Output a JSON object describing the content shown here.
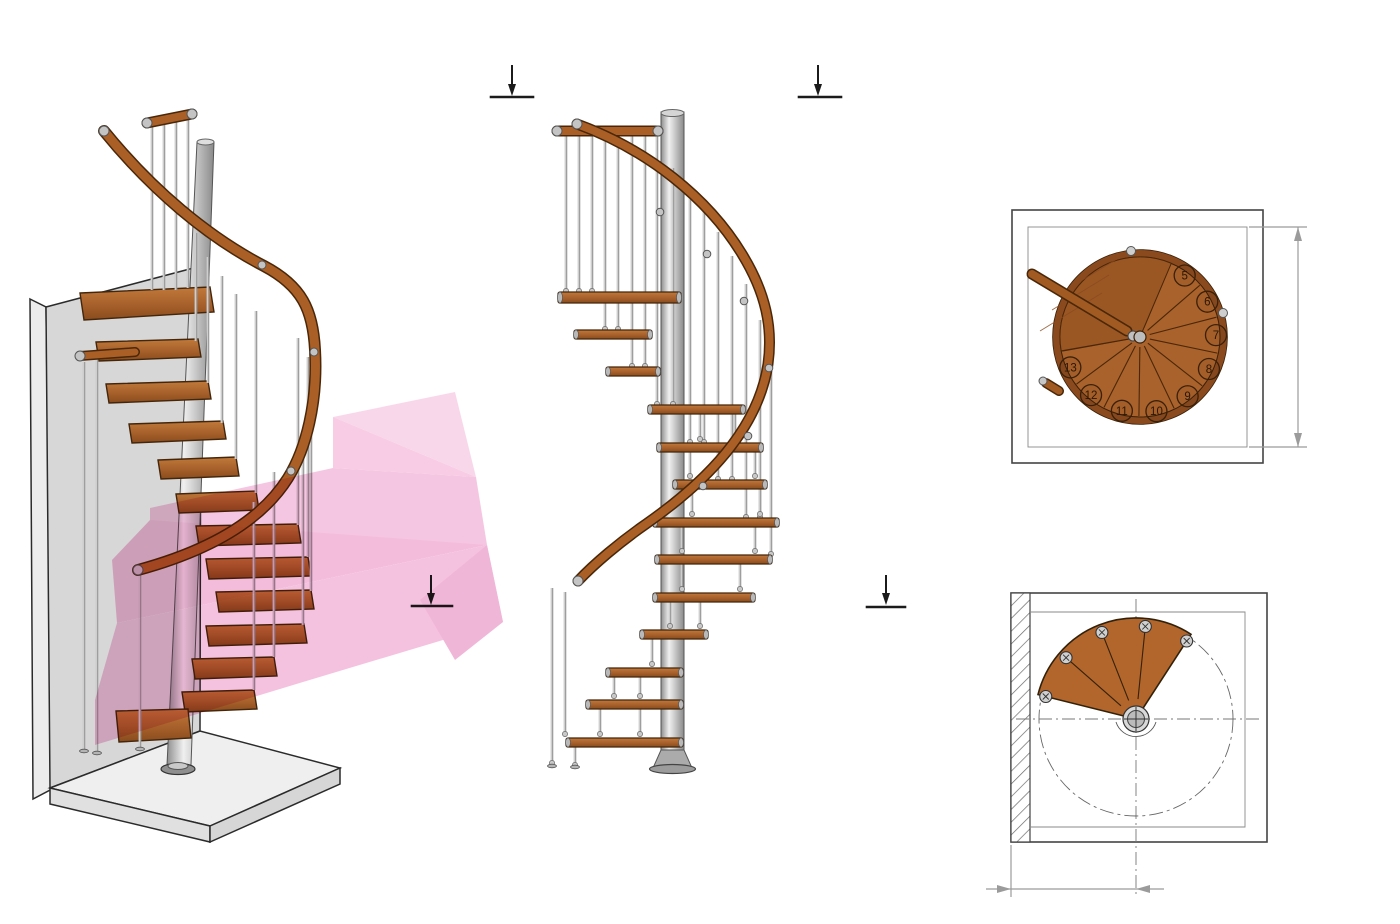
{
  "header": {
    "line1": "спиральная, правозабежная",
    "line2": "13 шагов (12 ступеней и площадка)",
    "line3": "Берёза Multiplex"
  },
  "watermark": {
    "line1": "ЛЕСТНИЦЫ",
    "line2_gray": "ПРОСТО",
    "line2_pink": ".ру",
    "gray_color": "#9a9a9a",
    "pink_color": "#e6267d",
    "arrow_pink": "#f2b5d7"
  },
  "sections": {
    "cc_title": "C-C",
    "dd_title": "D-D",
    "marker_c": "C",
    "marker_d": "D"
  },
  "dimensions": {
    "cc_square": "□1240",
    "dd_square": "□620"
  },
  "cc_plan": {
    "step_numbers": [
      "5",
      "6",
      "7",
      "8",
      "9",
      "10",
      "11",
      "12",
      "13"
    ]
  },
  "dd_plan": {
    "step_numbers": [
      "1",
      "2",
      "3",
      "4"
    ]
  },
  "colors": {
    "wood": "#a9622c",
    "wood_dark": "#43260b",
    "steel": "#b9b9b9",
    "wall": "#d7d7d7",
    "floor": "#efefef",
    "dim_gray": "#9b9b9b",
    "line": "#2e2e2e"
  }
}
